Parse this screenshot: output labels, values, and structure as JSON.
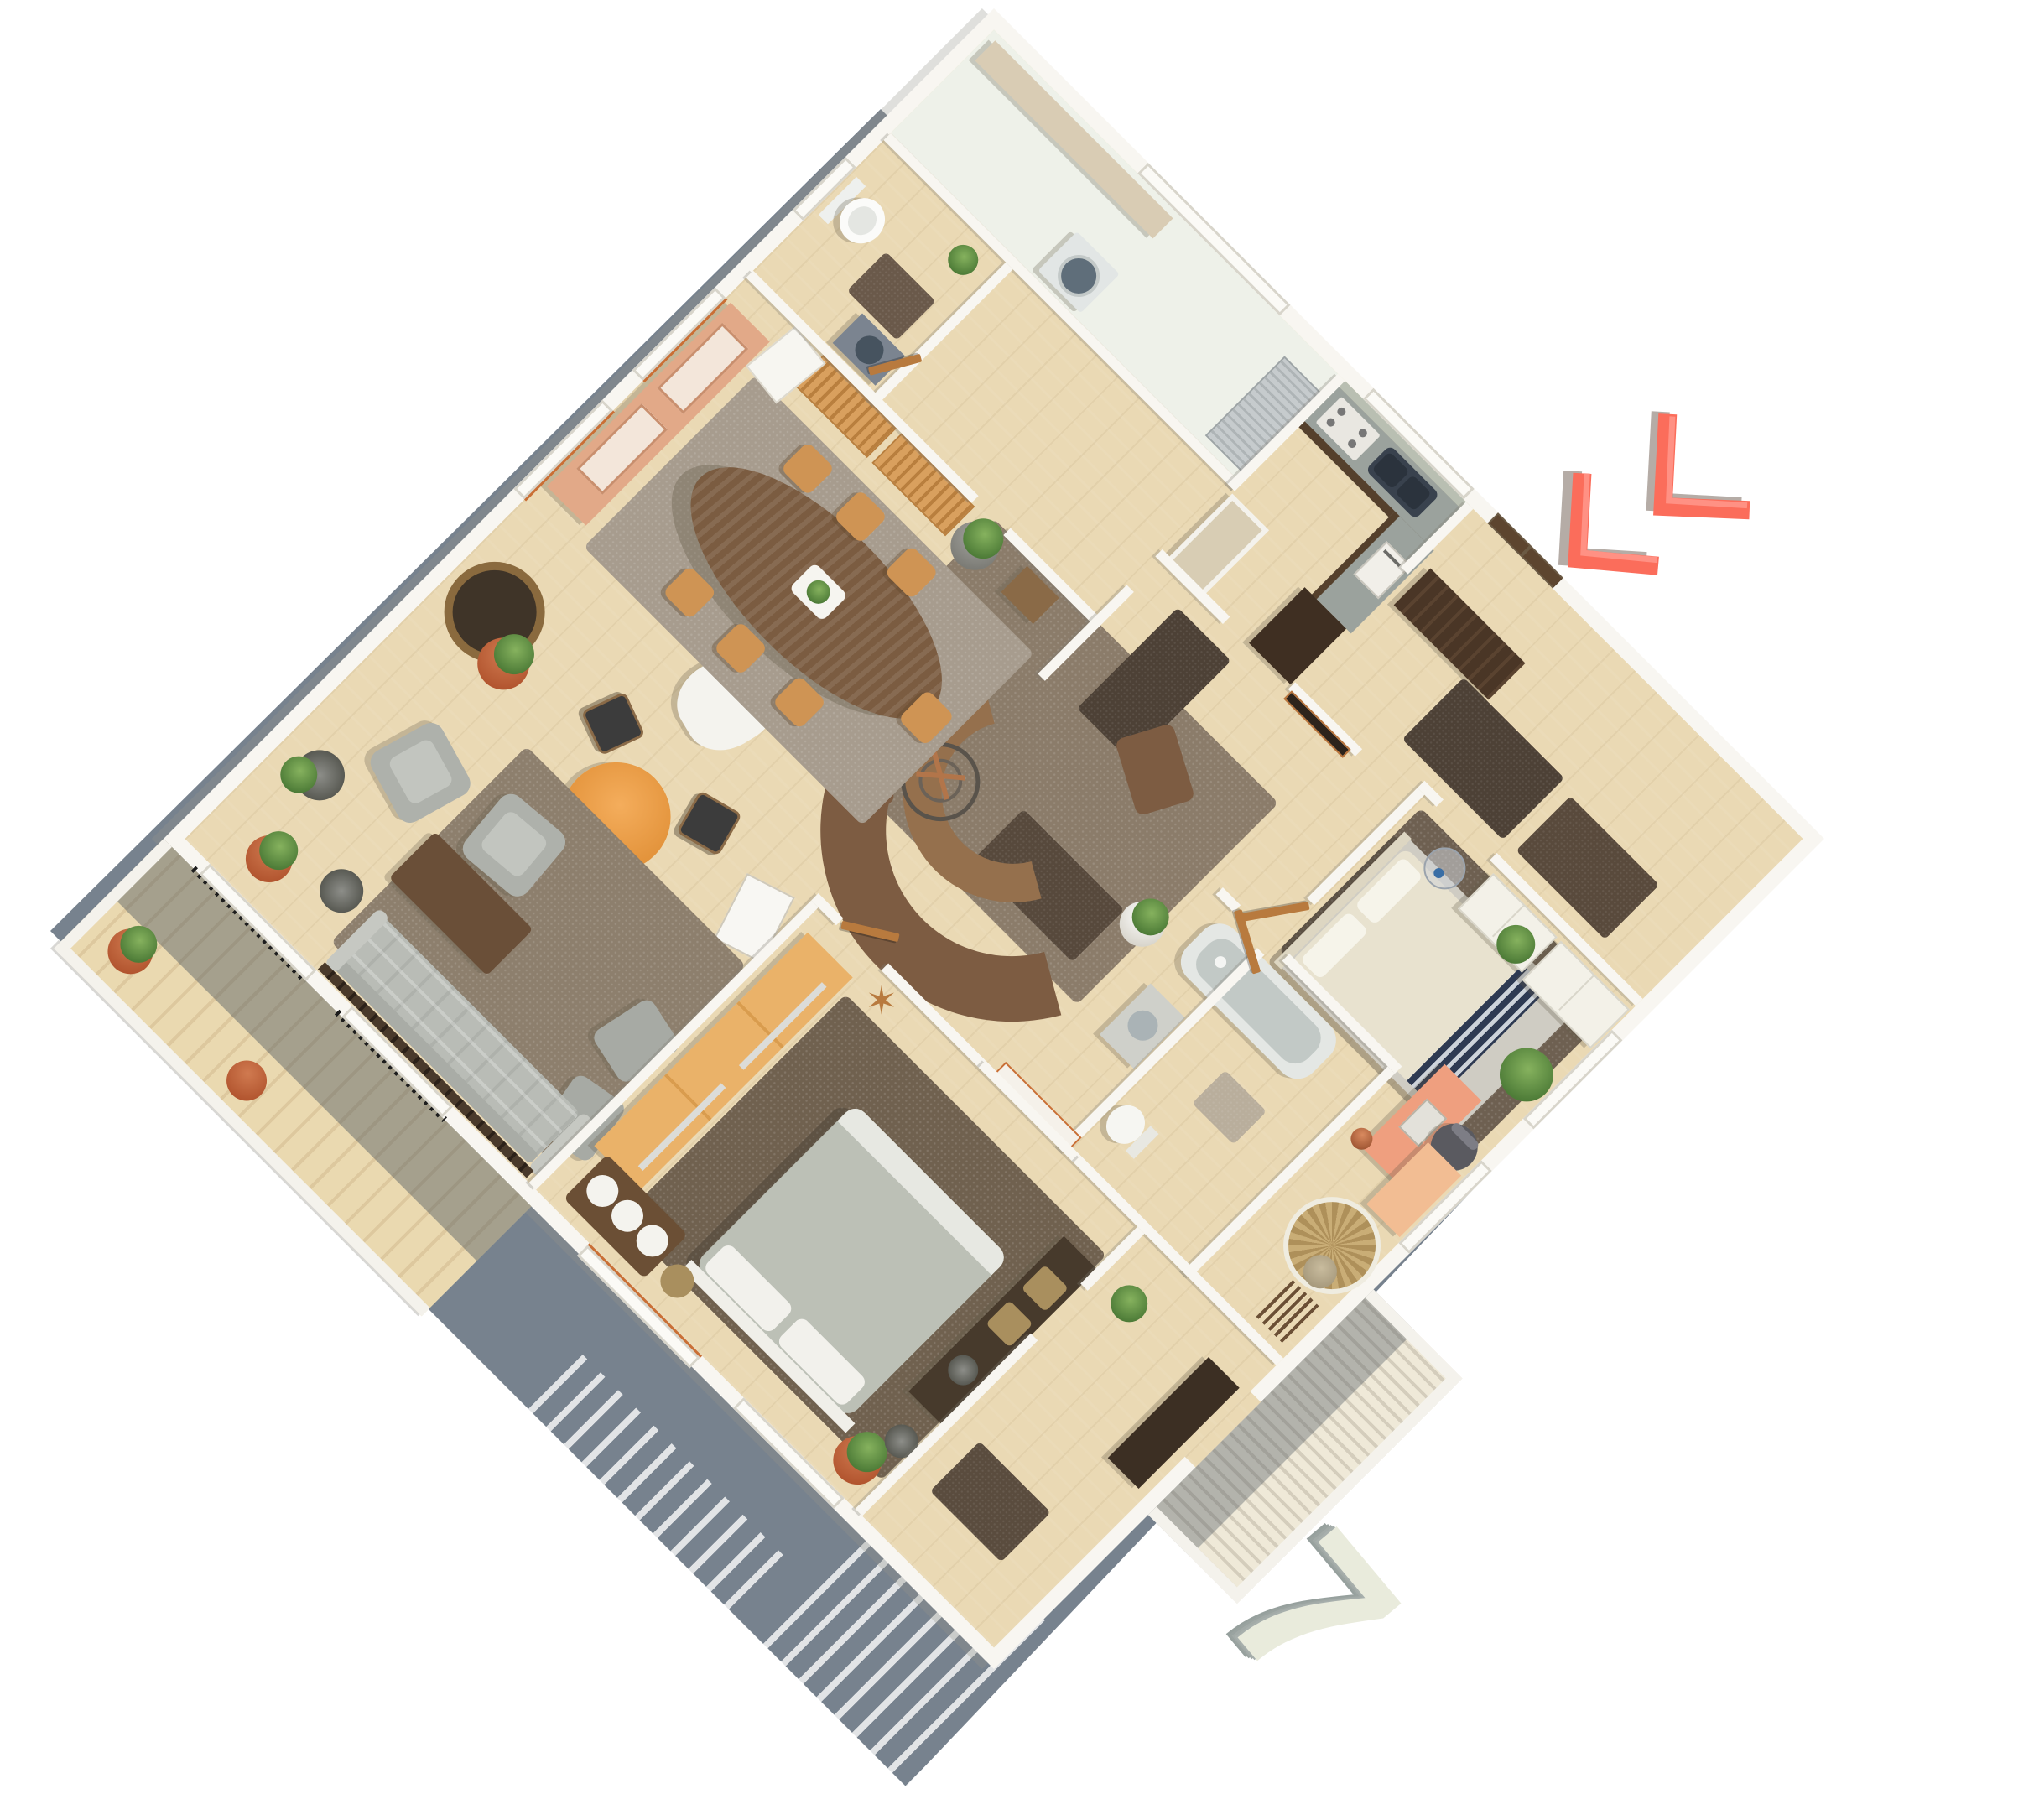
{
  "plan": {
    "unit_number": "7",
    "view": "3d-axonometric-floor-plan",
    "rotation_deg": 45,
    "star_decor_glyph": "✶",
    "entrance_arrow": {
      "icon": "double-chevron-arrow-icon",
      "color": "#fb6d5b",
      "highlight": "#ff9184",
      "shadow_color": "#b5aca6",
      "points_to": "entrance-door"
    },
    "numeral": {
      "face_color": "#e9ebdc",
      "side_color": "#9aa3a0"
    },
    "palette": {
      "background": "#ffffff",
      "ground_shadow": "#77828e",
      "wall": "#f8f6f1",
      "wall_shade": "#d6d3ca",
      "wood_floor": "#ead9b4",
      "pale_floor": "#eef1e9",
      "carpet_living": "#8b7c6a",
      "carpet_sitting": "#8d7f6d",
      "carpet_bedroom1": "#70614f",
      "carpet_bedroom2": "#6e6051",
      "rug_dining": "#a79c8e",
      "runner_dark": "#4d4136",
      "sofa_brown": "#7d5c42",
      "sofa_gray": "#b9bcb6",
      "armchair_gray": "#aeb1ab",
      "dining_table": "#7b5c41",
      "chair_oak": "#cf9454",
      "china_hutch": "#e2a988",
      "lattice_shelf": "#d9a05e",
      "wardrobe": "#eab269",
      "desk": "#ef9f7f",
      "storage_peach": "#f2bd93",
      "bed1_duvet": "#bcc0b6",
      "bed2_duvet": "#e8e2cf",
      "bed2_runner_navy": "#2e3a52",
      "bathtub": "#c2c9c6",
      "counter_top": "#9ba29d",
      "kitchen_cabinet_dark": "#55402c",
      "entry_closet": "#4a3626",
      "orange_table": "#efa04c",
      "terracotta": "#c4643e",
      "plant_green": "#5c8f46",
      "accent_frame": "#c96f35"
    },
    "rooms": [
      {
        "id": "utility-room",
        "furniture": [
          "counter",
          "washing-machine",
          "metal-rack",
          "threshold"
        ]
      },
      {
        "id": "wc",
        "furniture": [
          "toilet",
          "vanity-sink",
          "floor-mat",
          "small-plant"
        ]
      },
      {
        "id": "kitchen",
        "furniture": [
          "l-shaped-counter",
          "double-sink",
          "stove",
          "oven",
          "tall-cabinet",
          "island"
        ]
      },
      {
        "id": "entry-hall",
        "furniture": [
          "entrance-door",
          "entry-closet",
          "door-mats"
        ]
      },
      {
        "id": "living-room",
        "furniture": [
          "curved-sectional-sofa",
          "tv-panel",
          "gyro-decor",
          "white-lounge-chair",
          "area-rug",
          "hall-runners",
          "potted-plant",
          "deco-panel"
        ]
      },
      {
        "id": "dining-room",
        "furniture": [
          "oval-table",
          "centerpiece-tray",
          "dining-chairs",
          "china-hutch",
          "lattice-shelves",
          "leaning-artwork",
          "potted-plants",
          "rattan-chair",
          "orange-round-table",
          "black-chairs",
          "easel",
          "pink-side-table",
          "area-rug"
        ]
      },
      {
        "id": "sitting-area",
        "furniture": [
          "gray-sofa",
          "console-table",
          "armchairs",
          "side-chairs",
          "coffee-table",
          "floor-lamps",
          "potted-plants",
          "area-rug"
        ]
      },
      {
        "id": "bedroom-1",
        "furniture": [
          "double-bed",
          "pillows",
          "wardrobe",
          "media-console",
          "baskets",
          "bench",
          "vase-lamps",
          "potted-plant",
          "star-decor",
          "area-rug"
        ]
      },
      {
        "id": "bedroom-2",
        "furniture": [
          "double-bed",
          "striped-runner",
          "chests-of-drawers",
          "pendant-lamp",
          "desk",
          "office-chair",
          "papasan-chair",
          "coat-rack",
          "peach-cabinet",
          "copper-lamp",
          "vase",
          "palm-plants",
          "area-rug"
        ]
      },
      {
        "id": "bathroom",
        "furniture": [
          "bathtub",
          "vanity-sink",
          "toilet",
          "bath-mat"
        ]
      },
      {
        "id": "rear-hall",
        "furniture": [
          "dark-sideboard",
          "floor-mat",
          "potted-plant"
        ]
      },
      {
        "id": "balcony-main",
        "furniture": [
          "plank-floor",
          "parapet",
          "railings",
          "potted-plants"
        ]
      },
      {
        "id": "balcony-small",
        "furniture": [
          "slatted-floor",
          "parapet"
        ]
      }
    ]
  }
}
